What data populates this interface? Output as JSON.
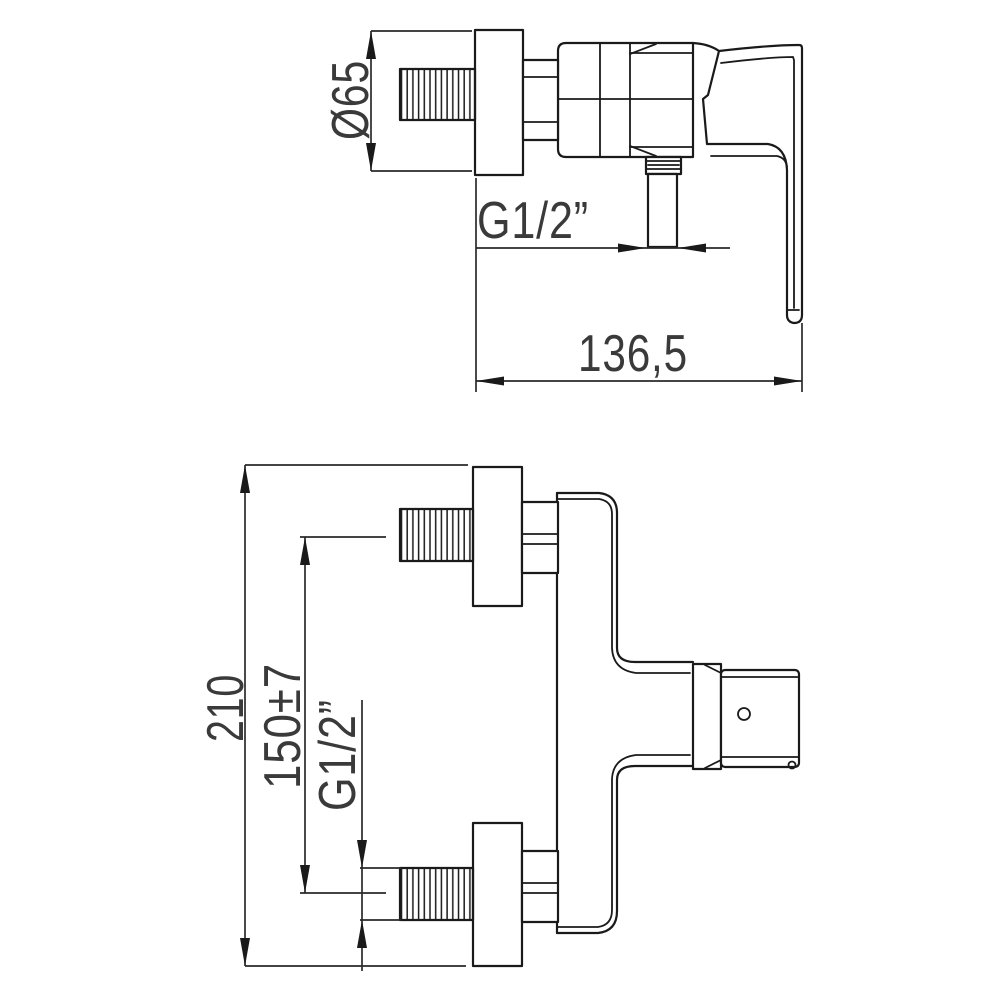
{
  "drawing": {
    "side_view": {
      "dimensions": {
        "flange_diameter": "Ø65",
        "outlet_thread": "G1/2”",
        "depth": "136,5"
      }
    },
    "front_view": {
      "dimensions": {
        "overall_height": "210",
        "connection_spacing": "150±7",
        "inlet_thread": "G1/2”"
      }
    }
  },
  "style": {
    "line_color": "#1a1a1a",
    "text_color": "#3a3a3a",
    "background": "#ffffff"
  }
}
